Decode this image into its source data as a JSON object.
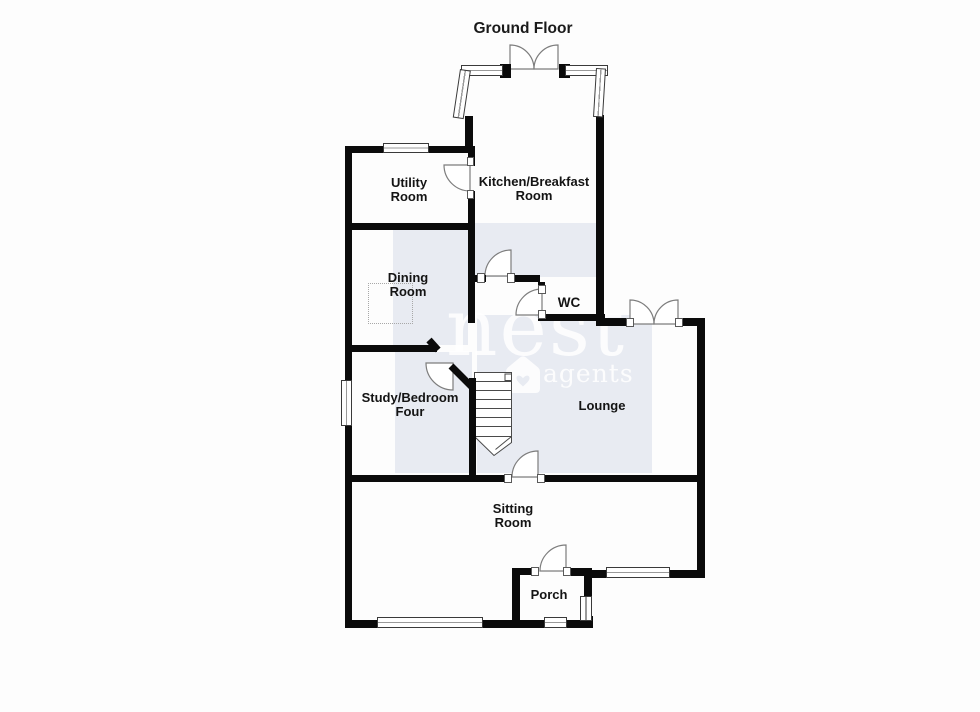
{
  "title": "Ground Floor",
  "watermark": {
    "name": "nest",
    "sub": "agents"
  },
  "rooms": {
    "utility": "Utility\nRoom",
    "kitchen": "Kitchen/Breakfast\nRoom",
    "dining": "Dining\nRoom",
    "wc": "WC",
    "study": "Study/Bedroom\nFour",
    "lounge": "Lounge",
    "sitting": "Sitting\nRoom",
    "porch": "Porch"
  },
  "colors": {
    "wall": "#0b0b0b",
    "room_shading": "#e8ebf2",
    "watermark": "rgba(255,255,255,0.85)",
    "label_text": "#141414"
  }
}
